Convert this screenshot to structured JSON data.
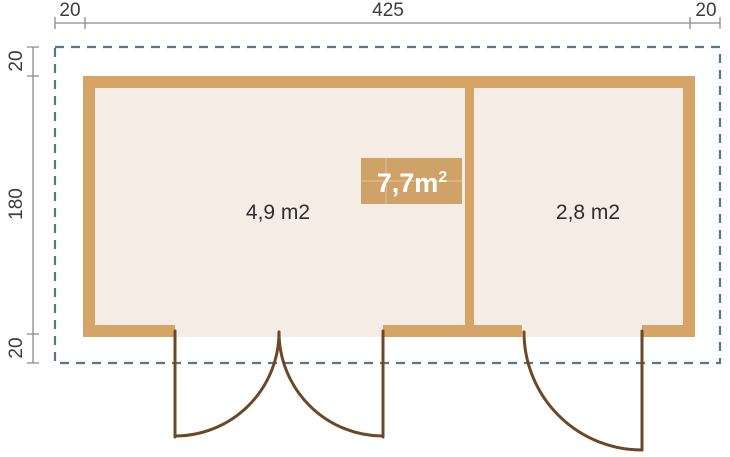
{
  "plan": {
    "type": "floor-plan",
    "rooms": [
      {
        "label": "4,9 m2"
      },
      {
        "label": "2,8 m2"
      }
    ],
    "total_area_badge": {
      "text": "7,7m",
      "sup": "2"
    },
    "dims": {
      "top": [
        "20",
        "425",
        "20"
      ],
      "left": [
        "20",
        "180",
        "20"
      ]
    }
  },
  "colors": {
    "background": "#ffffff",
    "wall": "#d4a566",
    "interior": "#f6ece6",
    "roof_outline": "#527891",
    "door": "#6d4826",
    "dimension_line": "#8a8a8a",
    "dimension_text": "#3c3c3c",
    "room_text": "#2d2d2d",
    "badge_bg": "#cfa267",
    "badge_text": "#ffffff"
  }
}
